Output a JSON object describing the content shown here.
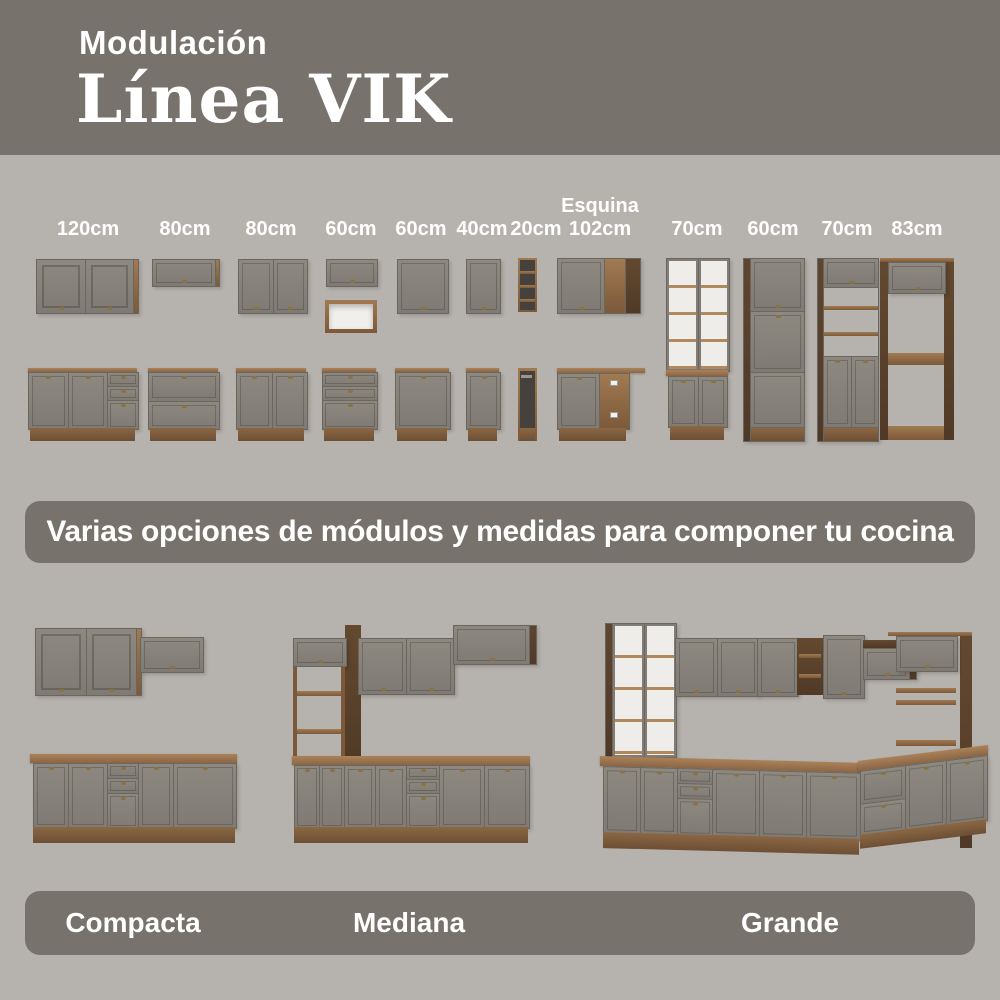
{
  "header": {
    "kicker": "Modulación",
    "title": "Línea VIK"
  },
  "modules": {
    "items": [
      {
        "label": "120cm"
      },
      {
        "label": "80cm"
      },
      {
        "label": "80cm"
      },
      {
        "label": "60cm"
      },
      {
        "label": "60cm"
      },
      {
        "label": "40cm"
      },
      {
        "label": "20cm"
      },
      {
        "sublabel": "Esquina",
        "label": "102cm"
      },
      {
        "label": "70cm"
      },
      {
        "label": "60cm"
      },
      {
        "label": "70cm"
      },
      {
        "label": "83cm"
      }
    ]
  },
  "banner": {
    "text": "Varias opciones de módulos y medidas para componer tu cocina"
  },
  "kitchens": {
    "items": [
      {
        "label": "Compacta"
      },
      {
        "label": "Mediana"
      },
      {
        "label": "Grande"
      }
    ]
  },
  "colors": {
    "page_background": "#b6b2ad",
    "header_background": "#77726b",
    "band_background": "#77726b",
    "cabinet_gray": "#87837c",
    "wood": "#936e4b",
    "dark_wood": "#5e4530",
    "text": "#ffffff"
  }
}
